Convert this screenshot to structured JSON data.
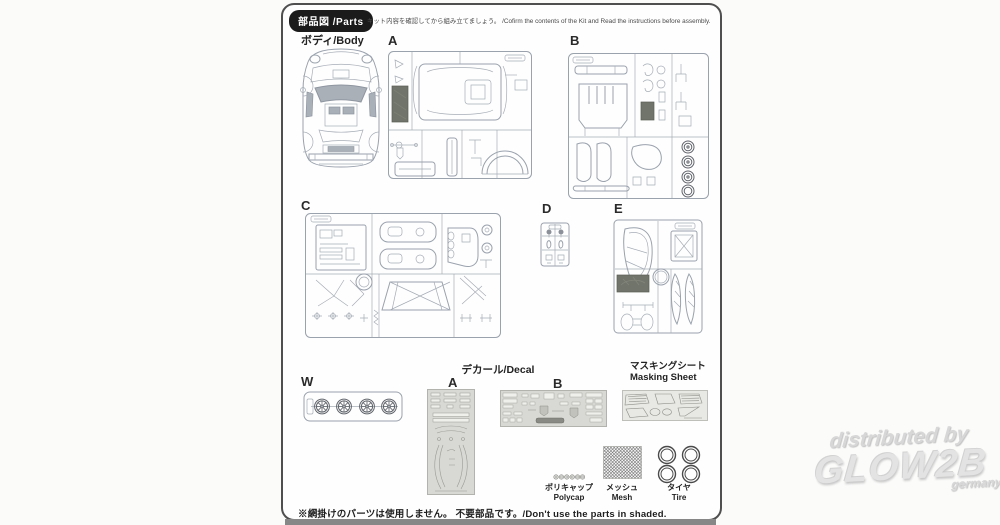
{
  "header": {
    "badge": "部品図 /Parts",
    "note": "キット内容を確認してから組み立てましょう。 /Cofirm the contents of the Kit and Read the instructions before assembly."
  },
  "body_section": {
    "label": "ボディ/Body"
  },
  "sprues": {
    "a": "A",
    "b": "B",
    "c": "C",
    "d": "D",
    "e": "E",
    "w": "W"
  },
  "decal": {
    "title": "デカール/Decal",
    "sheet_a": "A",
    "sheet_b": "B"
  },
  "masking": {
    "jp": "マスキングシート",
    "en": "Masking Sheet"
  },
  "accessories": {
    "polycap": {
      "jp": "ポリキャップ",
      "en": "Polycap"
    },
    "mesh": {
      "jp": "メッシュ",
      "en": "Mesh"
    },
    "tire": {
      "jp": "タイヤ",
      "en": "Tire"
    }
  },
  "footer": {
    "note": "※網掛けのパーツは使用しません。 不要部品です。/Don't use the parts in shaded."
  },
  "watermark": {
    "line1": "distributed by",
    "line2": "GLOW2B",
    "line3": "germany"
  },
  "colors": {
    "line_art": "#9aa2ad",
    "shaded_unused_part": "#70746a",
    "badge_bg": "#1b1b1b",
    "decal_sheet": "#d8d8d4",
    "masking_sheet": "#e8e8e4",
    "watermark": "#d7d7d7",
    "page_border": "#4f4f4f"
  }
}
